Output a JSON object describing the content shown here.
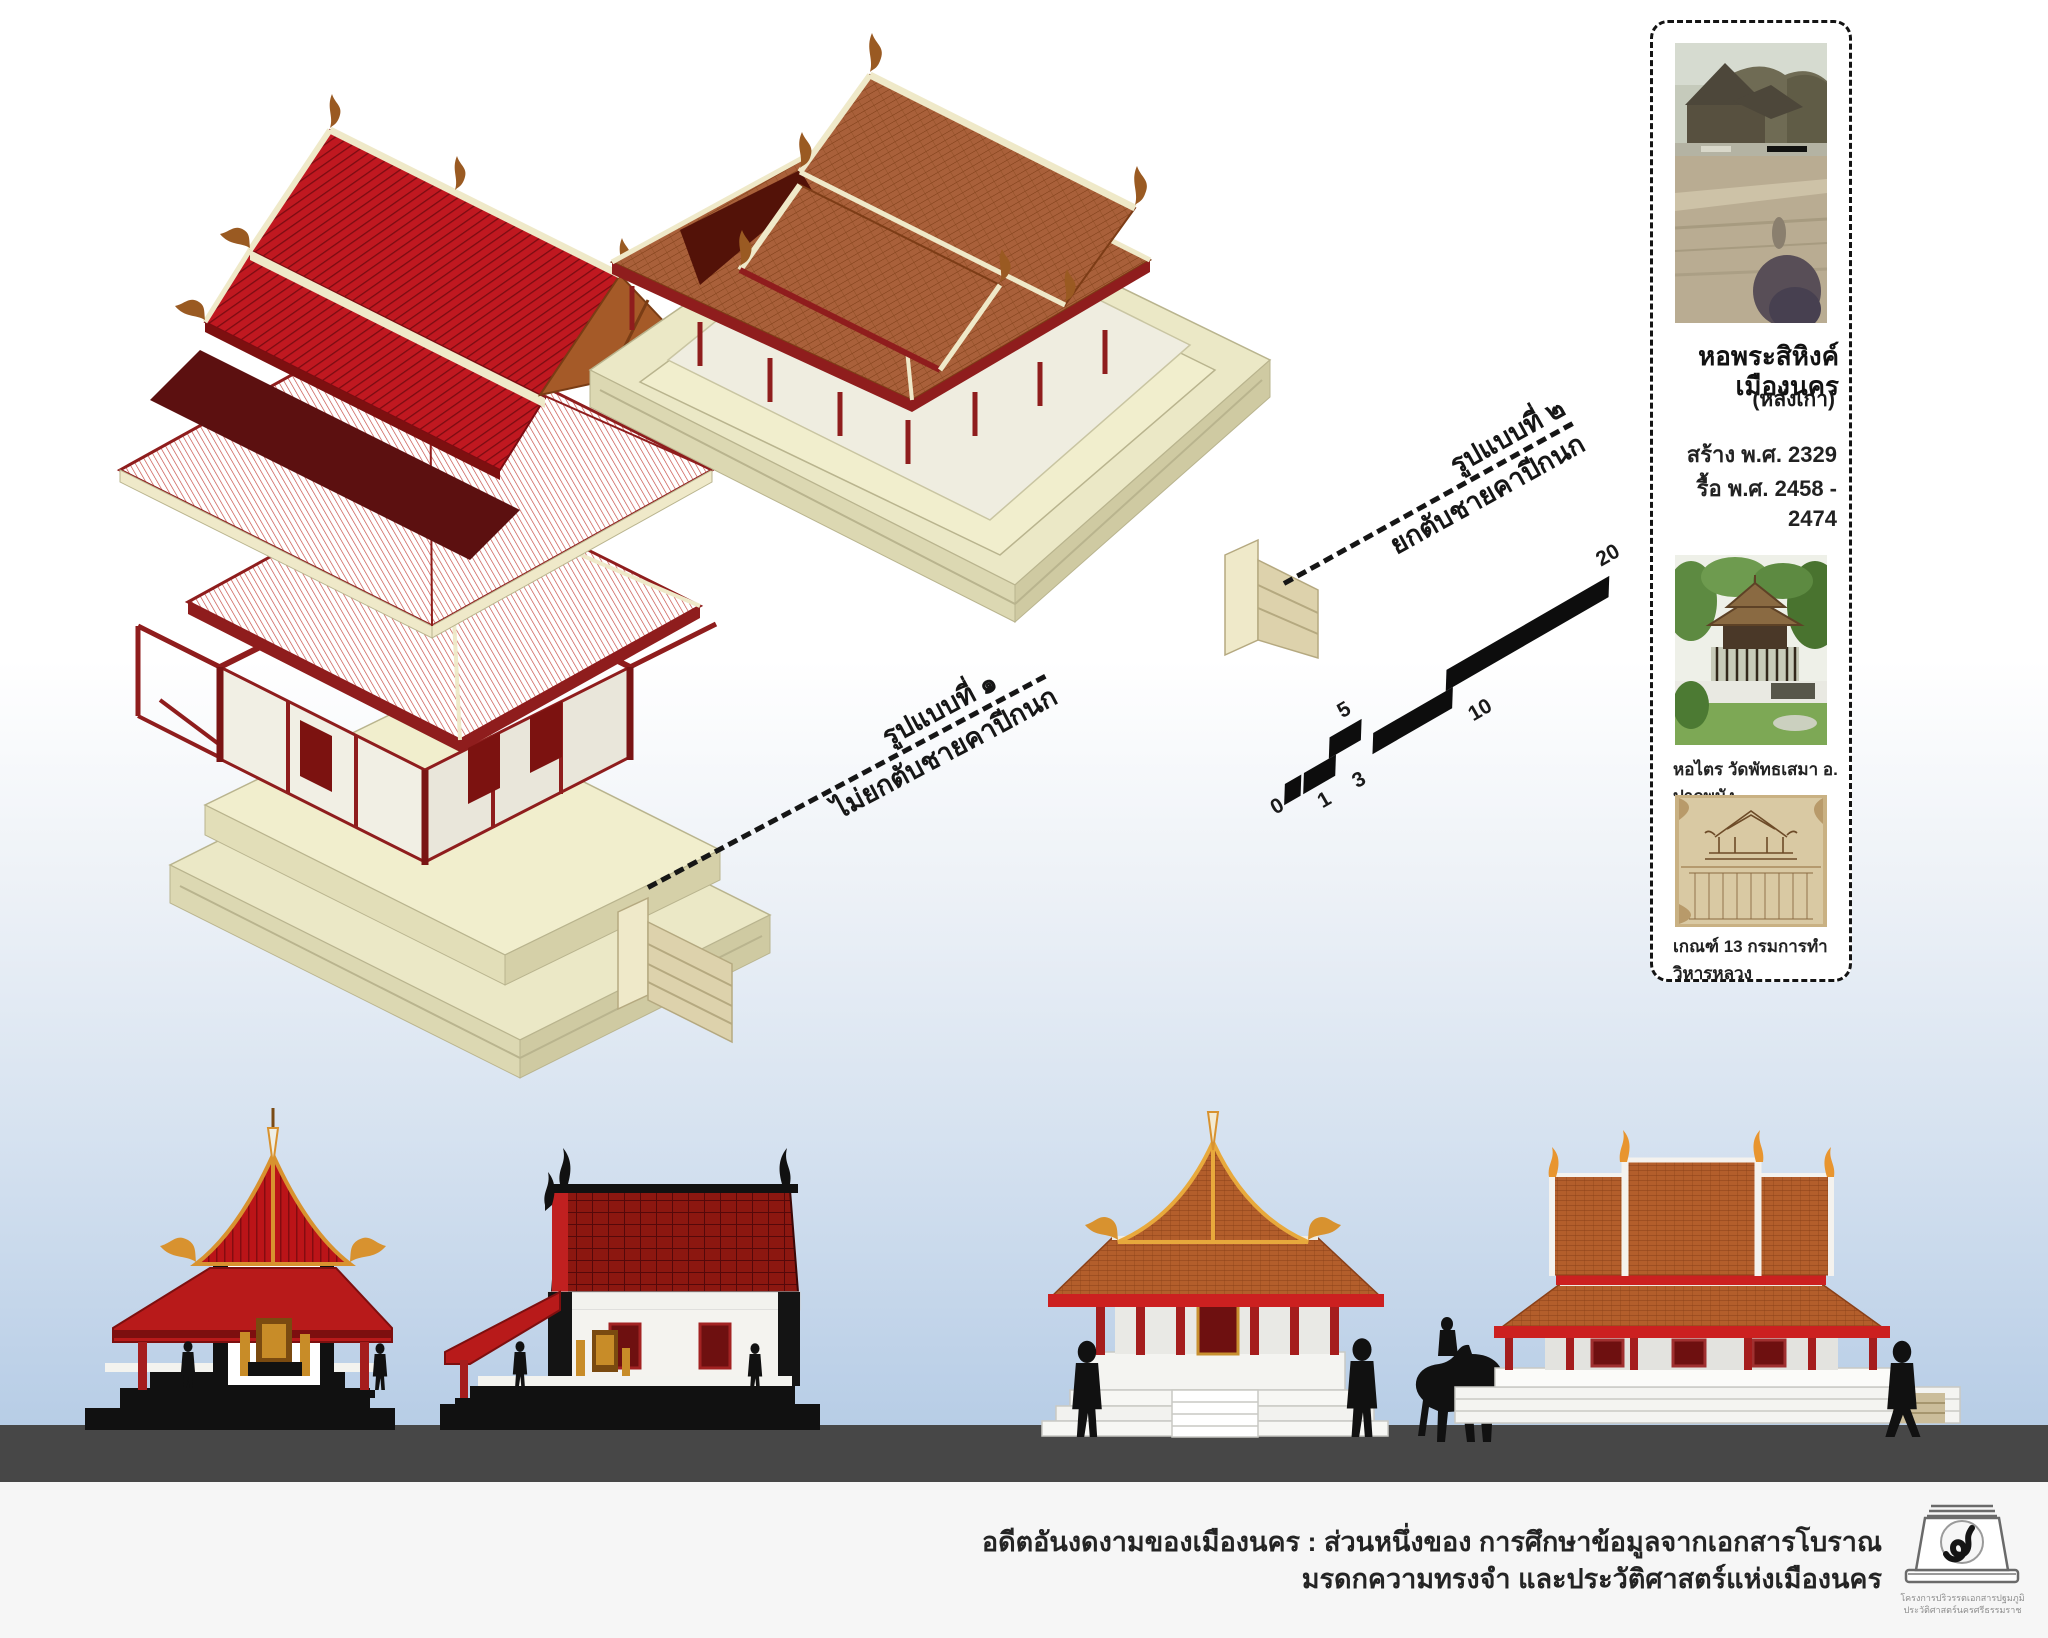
{
  "sidebar": {
    "title": "หอพระสิหิงค์เมืองนคร",
    "subtitle": "(หลังเก่า)",
    "built_line": "สร้าง พ.ศ. 2329",
    "demolished_line": "รื้อ พ.ศ. 2458 - 2474",
    "photo1_name": "old-photo-of-ho-phra-sihing",
    "photo2_caption": "หอไตร วัดพัทธเสมา อ. ปากพนัง",
    "photo3_caption": "เกณฑ์ 13 กรมการทำวิหารหลวง"
  },
  "labels": {
    "form1": {
      "line1": "รูปแบบที่ ๑",
      "line2": "ไม่ยกตับชายคาปีกนก"
    },
    "form2": {
      "line1": "รูปแบบที่ ๒",
      "line2": "ยกตับชายคาปีกนก"
    }
  },
  "scalebar": {
    "ticks": [
      "0",
      "1",
      "3",
      "5",
      "10",
      "20"
    ]
  },
  "footer": {
    "caption_line1": "อดีตอันงดงามของเมืองนคร : ส่วนหนึ่งของ การศึกษาข้อมูลจากเอกสารโบราณ",
    "caption_line2": "มรดกความทรงจำ และประวัติศาสตร์แห่งเมืองนคร",
    "logo_line1": "โครงการปริวรรตเอกสารปฐมภูมิ",
    "logo_line2": "ประวัติศาสตร์นครศรีธรรมราช"
  },
  "colors": {
    "roof_red": "#bb1518",
    "roof_orange_tile": "#af5e2e",
    "frame_dark_red": "#8f1d1d",
    "platform_cream": "#ebe8c6",
    "accent_red_band": "#cc2020",
    "ground_gray": "#474747",
    "sky_blue": "#b7cde6",
    "silhouette_black": "#111111",
    "gold": "#d8922f"
  }
}
